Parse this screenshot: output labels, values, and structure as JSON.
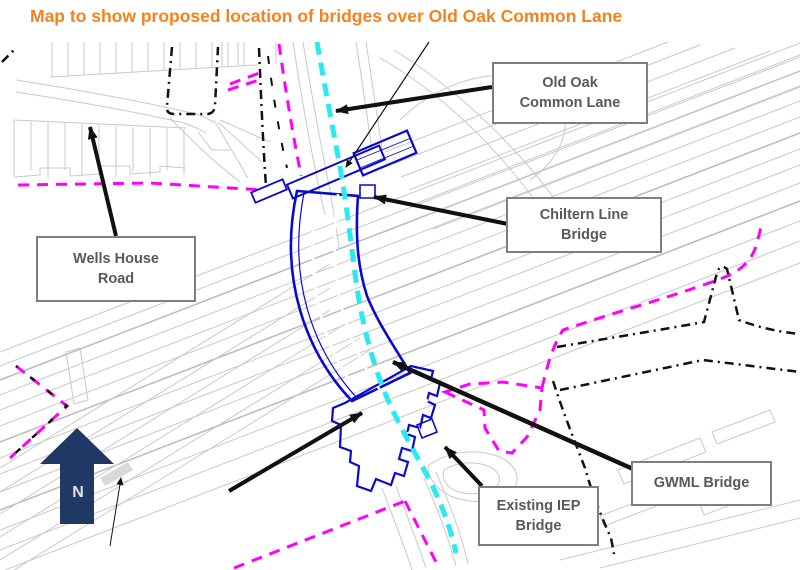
{
  "figure": {
    "title": "Map to show proposed location of bridges over Old Oak Common Lane"
  },
  "callouts": {
    "old_oak_common_lane": {
      "lines": [
        "Old Oak",
        "Common Lane"
      ]
    },
    "chiltern_line_bridge": {
      "lines": [
        "Chiltern Line",
        "Bridge"
      ]
    },
    "wells_house_road": {
      "lines": [
        "Wells House",
        "Road"
      ]
    },
    "gwml_bridge": {
      "lines": [
        "GWML Bridge"
      ]
    },
    "existing_iep_bridge": {
      "lines": [
        "Existing IEP",
        "Bridge"
      ]
    }
  },
  "north_arrow": {
    "label": "N"
  },
  "colors": {
    "title_orange": "#F6821E",
    "boundary_magenta": "#FF00FF",
    "route_cyan": "#29E9F2",
    "bridge_blue": "#0A0ACD",
    "north_navy": "#1F3864",
    "callout_text": "#595959",
    "callout_border": "#7F7F7F",
    "map_gray": "#C9C9C9",
    "leader_black": "#111111"
  }
}
